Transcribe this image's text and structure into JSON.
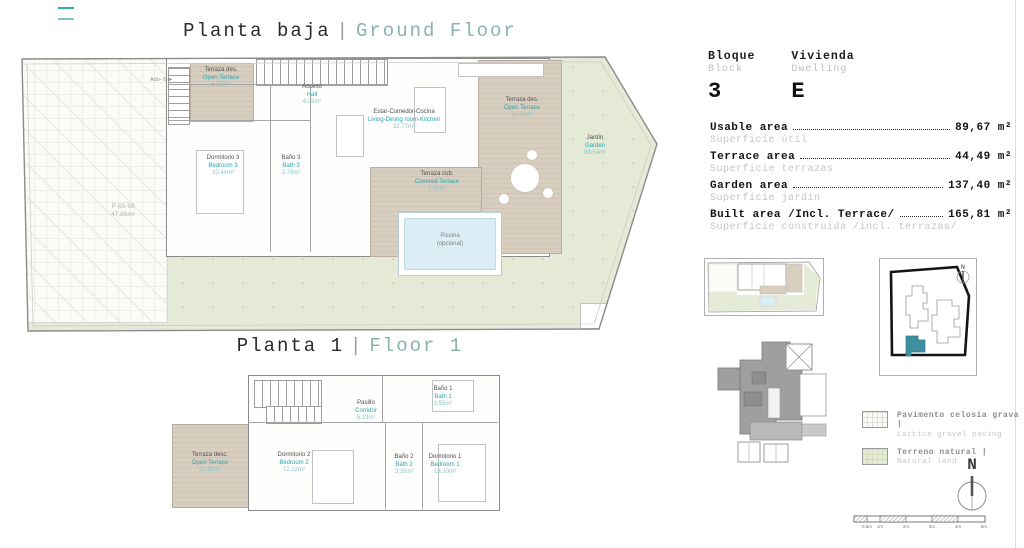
{
  "colors": {
    "accent_teal": "#2ba4ad",
    "title_teal": "#89b3af",
    "garden_green": "#e4ead6",
    "terrace_beige": "#d8cec0",
    "pool_blue": "#dceef5",
    "keyplan_unit_teal": "#3e8fa0"
  },
  "ground_floor": {
    "title_es": "Planta baja",
    "separator": "|",
    "title_en": "Ground Floor",
    "access_note": "Ado- 6 ►",
    "parcel_ref": {
      "code": "P-65-58",
      "area": "47.86m²"
    },
    "rooms": [
      {
        "name_es": "Terraza des.",
        "name_en": "Open Terrace",
        "area": "5.58m²"
      },
      {
        "name_es": "Acceso",
        "name_en": "Hall",
        "area": "4.29m²"
      },
      {
        "name_es": "Estar-Comedor-Cocina",
        "name_en": "Living-Dining room-Kitchen",
        "area": "32.77m²"
      },
      {
        "name_es": "Dormitorio 3",
        "name_en": "Bedroom 3",
        "area": "10.44m²"
      },
      {
        "name_es": "Baño 3",
        "name_en": "Bath 3",
        "area": "3.78m²"
      },
      {
        "name_es": "Terraza cub.",
        "name_en": "Covered Terrace",
        "area": "7.48m²"
      },
      {
        "name_es": "Terraza des.",
        "name_en": "Open Terrace",
        "area": "31.43m²"
      },
      {
        "name_es": "Jardín",
        "name_en": "Garden",
        "area": "89.54m²"
      }
    ],
    "pool": {
      "line1": "Piscina",
      "line2": "(opcional)"
    }
  },
  "floor1": {
    "title_es": "Planta 1",
    "separator": "|",
    "title_en": "Floor 1",
    "rooms": [
      {
        "name_es": "Terraza desc.",
        "name_en": "Open Terrace",
        "area": "18.59m²"
      },
      {
        "name_es": "Pasillo",
        "name_en": "Corridor",
        "area": "5.13m²"
      },
      {
        "name_es": "Baño 1",
        "name_en": "Bath 1",
        "area": "3.55m²"
      },
      {
        "name_es": "Dormitorio 2",
        "name_en": "Bedroom 2",
        "area": "12.12m²"
      },
      {
        "name_es": "Baño 2",
        "name_en": "Bath 2",
        "area": "3.35m²"
      },
      {
        "name_es": "Dormitorio 1",
        "name_en": "Bedroom 1",
        "area": "13.20m²"
      }
    ]
  },
  "unit_info": {
    "bloque": {
      "label_es": "Bloque",
      "label_en": "Block",
      "value": "3"
    },
    "vivienda": {
      "label_es": "Vivienda",
      "label_en": "Dwelling",
      "value": "E"
    }
  },
  "areas": [
    {
      "label_en": "Usable area",
      "label_es": "Superficie útil",
      "value": "89,67",
      "unit": "m²"
    },
    {
      "label_en": "Terrace area",
      "label_es": "Superficie terrazas",
      "value": "44,49",
      "unit": "m²"
    },
    {
      "label_en": "Garden area",
      "label_es": "Superficie jardín",
      "value": "137,40",
      "unit": "m²"
    },
    {
      "label_en": "Built area /Incl. Terrace/",
      "label_es": "Superficie construida /incl. terrazas/",
      "value": "165,81",
      "unit": "m²"
    }
  ],
  "legend": [
    {
      "label_es": "Pavimento celosía grava |",
      "label_en": "Lattice gravel paving",
      "swatch": "hatch"
    },
    {
      "label_es": "Terreno natural |",
      "label_en": "Natural land",
      "swatch": "green"
    }
  ],
  "compass": {
    "label": "N"
  },
  "keyplan": {
    "compass_label": "N"
  },
  "scalebar": {
    "labels": [
      "0.5m",
      "1m",
      "2m",
      "3m",
      "4m",
      "5m"
    ]
  }
}
